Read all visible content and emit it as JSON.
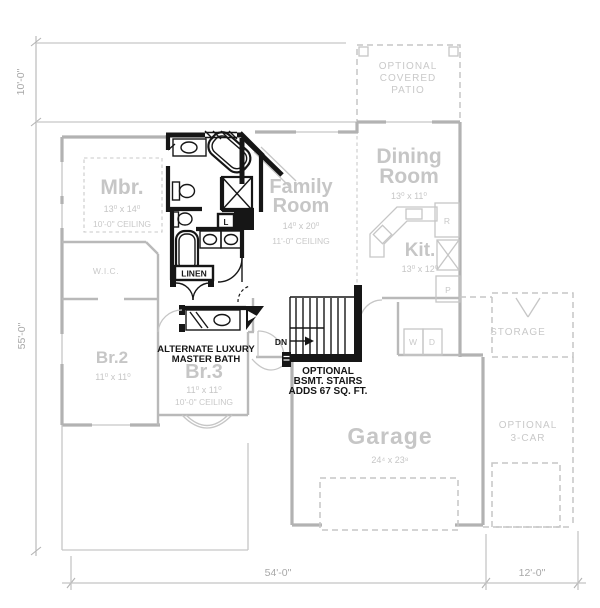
{
  "title": "floor-plan-alternate-options",
  "colors": {
    "background": "#ffffff",
    "base_plan_wall": "#b2b2b2",
    "base_plan_text": "#c6c6c6",
    "dimension_text": "#a8a8a8",
    "option_dark": "#161616"
  },
  "dimensions": {
    "left_upper": "10'-0\"",
    "left_main": "55'-0\"",
    "bottom_main": "54'-0\"",
    "bottom_right": "12'-0\""
  },
  "rooms": {
    "mbr": {
      "name": "Mbr.",
      "size": "13⁰ x 14⁰",
      "ceiling": "10'-0\" CEILING"
    },
    "wic": {
      "name": "W.I.C."
    },
    "family": {
      "name1": "Family",
      "name2": "Room",
      "size": "14⁰ x 20⁰",
      "ceiling": "11'-0\" CEILING"
    },
    "dining": {
      "name1": "Dining",
      "name2": "Room",
      "size": "13⁰ x 11⁰"
    },
    "kitchen": {
      "name": "Kit.",
      "size": "13⁰ x 12⁰"
    },
    "br2": {
      "name": "Br.2",
      "size": "11⁰ x 11⁰"
    },
    "br3": {
      "name": "Br.3",
      "size": "11⁰ x 11⁰",
      "ceiling": "10'-0\" CEILING"
    },
    "garage": {
      "name": "Garage",
      "size": "24⁴ x 23⁸"
    },
    "patio": {
      "line1": "OPTIONAL",
      "line2": "COVERED",
      "line3": "PATIO"
    },
    "storage": {
      "name": "STORAGE"
    },
    "three_car": {
      "line1": "OPTIONAL",
      "line2": "3-CAR"
    }
  },
  "annotations": {
    "alt_bath": {
      "line1": "ALTERNATE LUXURY",
      "line2": "MASTER BATH"
    },
    "bsmt_stairs": {
      "line1": "OPTIONAL",
      "line2": "BSMT. STAIRS",
      "line3": "ADDS 67 SQ. FT."
    }
  },
  "labels": {
    "linen": "LINEN",
    "linen_short": "L",
    "down": "DN",
    "washer": "W",
    "dryer": "D",
    "refrigerator": "R",
    "pantry": "P"
  }
}
